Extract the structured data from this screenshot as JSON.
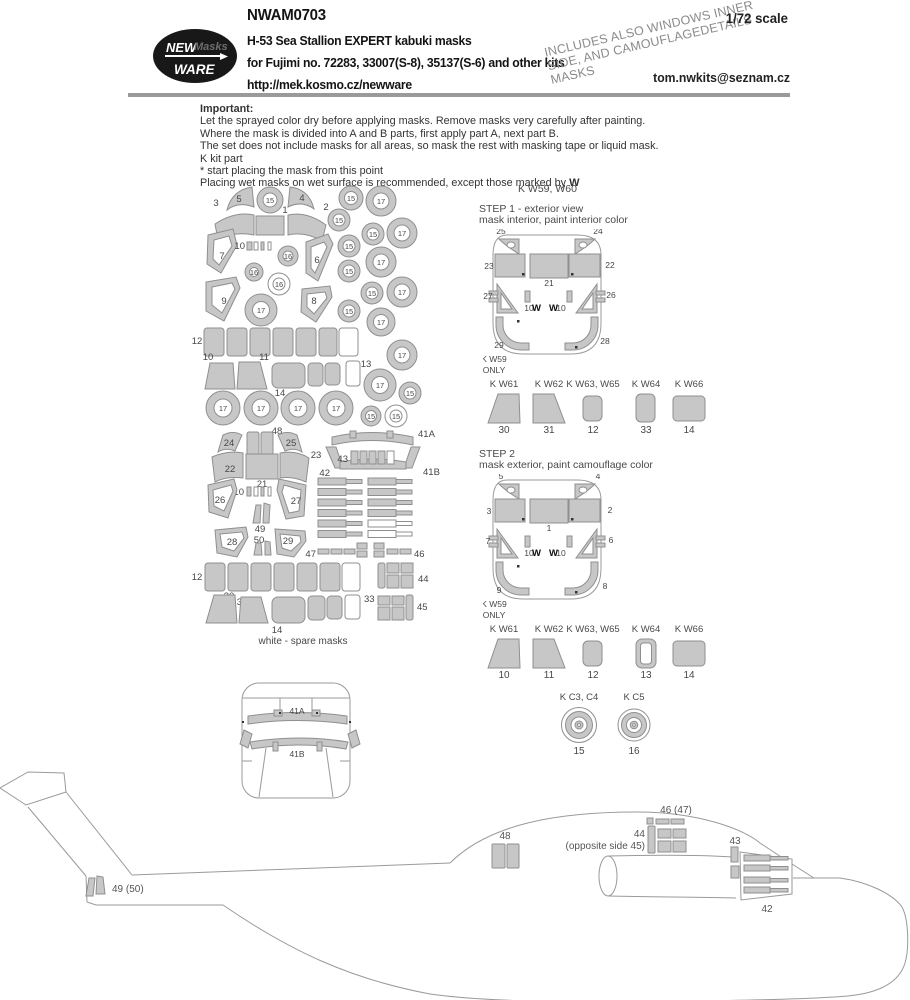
{
  "header": {
    "logo": {
      "new": "NEW",
      "masks": "Masks",
      "ware": "WARE"
    },
    "product_code": "NWAM0703",
    "title": "H-53 Sea Stallion EXPERT kabuki masks",
    "subtitle": "for Fujimi no. 72283, 33007(S-8), 35137(S-6) and other kits",
    "url": "http://mek.kosmo.cz/newware",
    "scale": "1/72 scale",
    "email": "tom.nwkits@seznam.cz",
    "diagonal_note": {
      "line1": "INCLUDES ALSO WINDOWS INNER",
      "line2": "SIDE, AND CAMOUFLAGEDETAILS",
      "line3": "MASKS"
    }
  },
  "important": {
    "heading": "Important:",
    "lines": [
      "Let the sprayed color dry before applying masks. Remove masks very carefully after painting.",
      "Where the mask is divided into A and B parts, first apply part A, next part B.",
      "The set does not include masks for all areas, so mask the rest with masking tape or liquid mask.",
      "K kit part",
      "*  start placing the mask from this point",
      "Placing wet masks on wet surface is recommended, except those marked by"
    ],
    "w_mark": "W"
  },
  "sheet": {
    "labels": {
      "1": "1",
      "2": "2",
      "3": "3",
      "4": "4",
      "5": "5",
      "6": "6",
      "7": "7",
      "8": "8",
      "9": "9",
      "10": "10",
      "11": "11",
      "12": "12",
      "13": "13",
      "14": "14",
      "15": "15",
      "16": "16",
      "17": "17",
      "21": "21",
      "22": "22",
      "23": "23",
      "24": "24",
      "25": "25",
      "26": "26",
      "27": "27",
      "28": "28",
      "29": "29",
      "30": "30",
      "31": "31",
      "33": "33",
      "41A": "41A",
      "41B": "41B",
      "42": "42",
      "43": "43",
      "44": "44",
      "45": "45",
      "46": "46",
      "47": "47",
      "48": "48",
      "49": "49",
      "50": "50"
    },
    "caption": "white - spare masks"
  },
  "step1": {
    "kit_note": "K W59, W60",
    "title": "STEP 1 - exterior view",
    "subtitle": "mask interior, paint interior color",
    "corner_left": "25",
    "corner_right": "24",
    "win_left": "23",
    "win_center": "21",
    "win_right": "22",
    "side_left": "27",
    "side_right": "26",
    "strip": "10",
    "w": "W",
    "bottom_left": "29",
    "bottom_right": "28",
    "only1": "K W59",
    "only2": "ONLY"
  },
  "step2": {
    "title": "STEP 2",
    "subtitle": "mask exterior, paint camouflage color",
    "corner_left": "5",
    "corner_right": "4",
    "win_left": "3",
    "win_center": "1",
    "win_right": "2",
    "side_left": "7",
    "side_right": "6",
    "strip": "10",
    "w": "W",
    "bottom_left": "9",
    "bottom_right": "8",
    "only1": "K W59",
    "only2": "ONLY"
  },
  "window_row1": {
    "items": [
      {
        "kit": "K W61",
        "num": "30"
      },
      {
        "kit": "K W62",
        "num": "31"
      },
      {
        "kit": "K W63, W65",
        "num": "12"
      },
      {
        "kit": "K W64",
        "num": "33"
      },
      {
        "kit": "K W66",
        "num": "14"
      }
    ]
  },
  "window_row2": {
    "items": [
      {
        "kit": "K W61",
        "num": "10"
      },
      {
        "kit": "K W62",
        "num": "11"
      },
      {
        "kit": "K W63, W65",
        "num": "12"
      },
      {
        "kit": "K W64",
        "num": "13"
      },
      {
        "kit": "K W66",
        "num": "14"
      }
    ]
  },
  "wheels": {
    "items": [
      {
        "kit": "K C3, C4",
        "num": "15"
      },
      {
        "kit": "K C5",
        "num": "16"
      }
    ]
  },
  "front_view": {
    "top": "41A",
    "bottom": "41B"
  },
  "side_view": {
    "l49": "49 (50)",
    "l48": "48",
    "l46": "46 (47)",
    "l44": "44",
    "l45": "(opposite side 45)",
    "l43": "43",
    "l42": "42"
  }
}
